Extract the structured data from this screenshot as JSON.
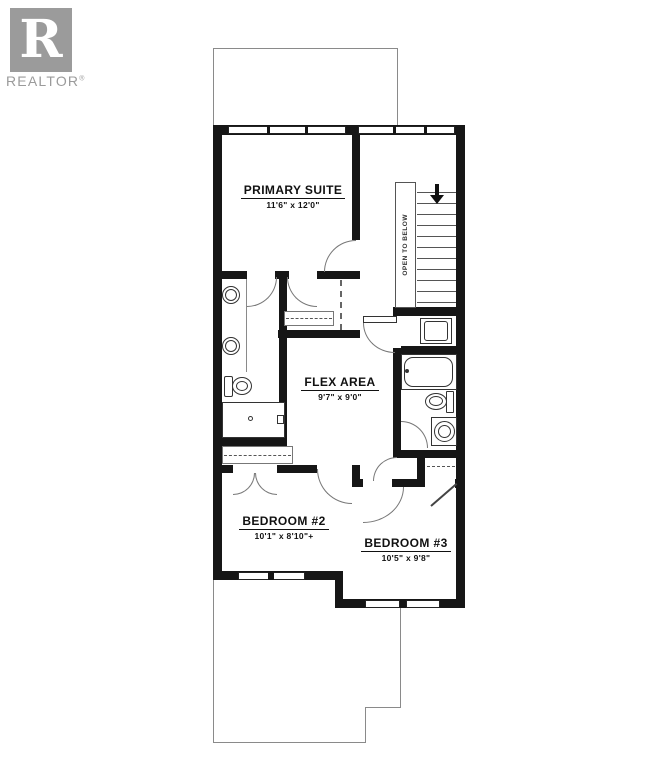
{
  "branding": {
    "logo_letter": "R",
    "name": "REALTOR",
    "registered": "®"
  },
  "rooms": {
    "primary_suite": {
      "name": "PRIMARY SUITE",
      "dims": "11'6\" x 12'0\""
    },
    "flex_area": {
      "name": "FLEX AREA",
      "dims": "9'7\" x 9'0\""
    },
    "bedroom_2": {
      "name": "BEDROOM #2",
      "dims": "10'1\" x 8'10\"+"
    },
    "bedroom_3": {
      "name": "BEDROOM #3",
      "dims": "10'5\" x 9'8\""
    }
  },
  "stairs": {
    "note": "OPEN TO BELOW",
    "direction": "down"
  },
  "colors": {
    "wall": "#161616",
    "logo_gray": "#9b9b9b"
  }
}
